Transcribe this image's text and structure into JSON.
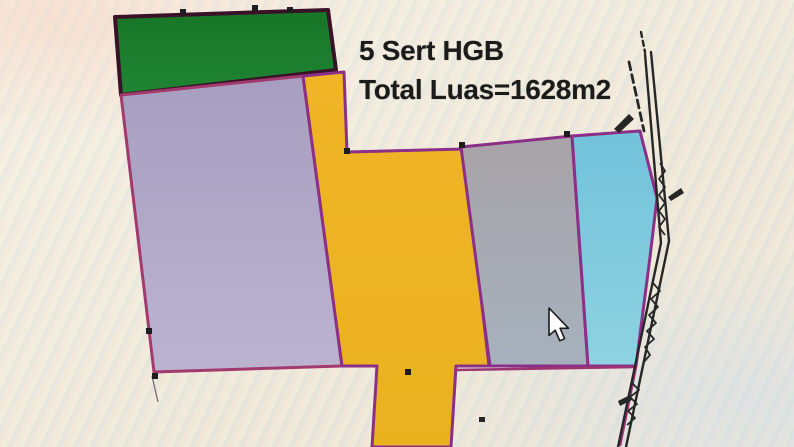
{
  "annotation": {
    "line1": "5 Sert HGB",
    "line2": "Total Luas=1628m2",
    "color": "#1b1b1b"
  },
  "map": {
    "width": 794,
    "height": 447,
    "background_color": "#f2eedd",
    "border_color": "#8c2f86",
    "parcels": [
      {
        "name": "parcel-green",
        "fill": "#177627",
        "fill2": "#1f8433",
        "stroke": "#3a1228",
        "stroke_width": 4,
        "points": "115,17 328,10 336,70 121,95"
      },
      {
        "name": "parcel-lavender",
        "fill": "#a79ec0",
        "fill2": "#bcb3d1",
        "stroke": "#a23a6e",
        "stroke_width": 3,
        "points": "121,95 303,76 342,366 154,372"
      },
      {
        "name": "parcel-yellow",
        "fill": "#efb527",
        "fill2": "#eab11f",
        "stroke": "#8c2f86",
        "stroke_width": 3,
        "points": "303,76 344,72 347,152 464,149 489,366 456,366 451,447 372,447 377,366 342,366"
      },
      {
        "name": "parcel-gray",
        "fill": "#a8a3a8",
        "fill2": "#a6b1bd",
        "stroke": "#8c2f86",
        "stroke_width": 3,
        "points": "461,147 572,136 588,366 490,366"
      },
      {
        "name": "parcel-blue",
        "fill": "#72c2da",
        "fill2": "#8ed2e2",
        "stroke": "#8c2f86",
        "stroke_width": 3,
        "points": "572,136 640,131 657,198 650,257 636,366 588,366"
      },
      {
        "name": "parcel-outline-bottom-right",
        "fill": "none",
        "stroke": "#9c3373",
        "stroke_width": 2.5,
        "points": "454,370 636,367 620,446",
        "open": true
      }
    ],
    "handles": [
      {
        "x": 344,
        "y": 148
      },
      {
        "x": 459,
        "y": 142
      },
      {
        "x": 564,
        "y": 131
      },
      {
        "x": 146,
        "y": 328
      },
      {
        "x": 152,
        "y": 373
      },
      {
        "x": 405,
        "y": 369
      },
      {
        "x": 180,
        "y": 9
      },
      {
        "x": 252,
        "y": 5
      },
      {
        "x": 287,
        "y": 7
      }
    ],
    "handle_color": "#1d1d1d",
    "handle_size": 6,
    "road": {
      "color": "#262626",
      "lines": [
        {
          "points": "645,54 661,243 618,447",
          "width": 2.4,
          "dash": ""
        },
        {
          "points": "651,52 669,241 626,447",
          "width": 2.4,
          "dash": ""
        },
        {
          "points": "629,62 644,131",
          "width": 2.8,
          "dash": "8 5"
        },
        {
          "points": "641,32 645,52",
          "width": 2.4,
          "dash": "5 4"
        }
      ],
      "squiggles": [
        {
          "points": "660,163 665,171 659,179 665,187 659,195 665,203 659,211 665,219 659,227 665,235",
          "width": 1.8
        },
        {
          "points": "653,283 660,291 651,299 658,307 649,315 656,323 647,331 654,339 645,347 650,355 643,363",
          "width": 1.8
        },
        {
          "points": "632,383 639,390 630,397 637,404 628,411 635,418 627,425",
          "width": 1.8
        }
      ],
      "marks": [
        {
          "name": "road-mark-flag-top",
          "points": "614,129 629,114 634,119 619,133"
        },
        {
          "name": "road-mark-right",
          "points": "668,197 681,188 684,193 671,201"
        },
        {
          "name": "road-mark-mid",
          "points": "618,401 630,395 632,400 620,406"
        },
        {
          "name": "stray-dot",
          "points": "479,417 485,417 485,422 479,422"
        }
      ]
    },
    "scratch": {
      "points": "152,376 158,402",
      "color": "#6a6470",
      "width": 1.2
    },
    "cursor": {
      "x": 549,
      "y": 308,
      "fill": "#fdfdfd",
      "outline": "#1b1b1b"
    }
  }
}
